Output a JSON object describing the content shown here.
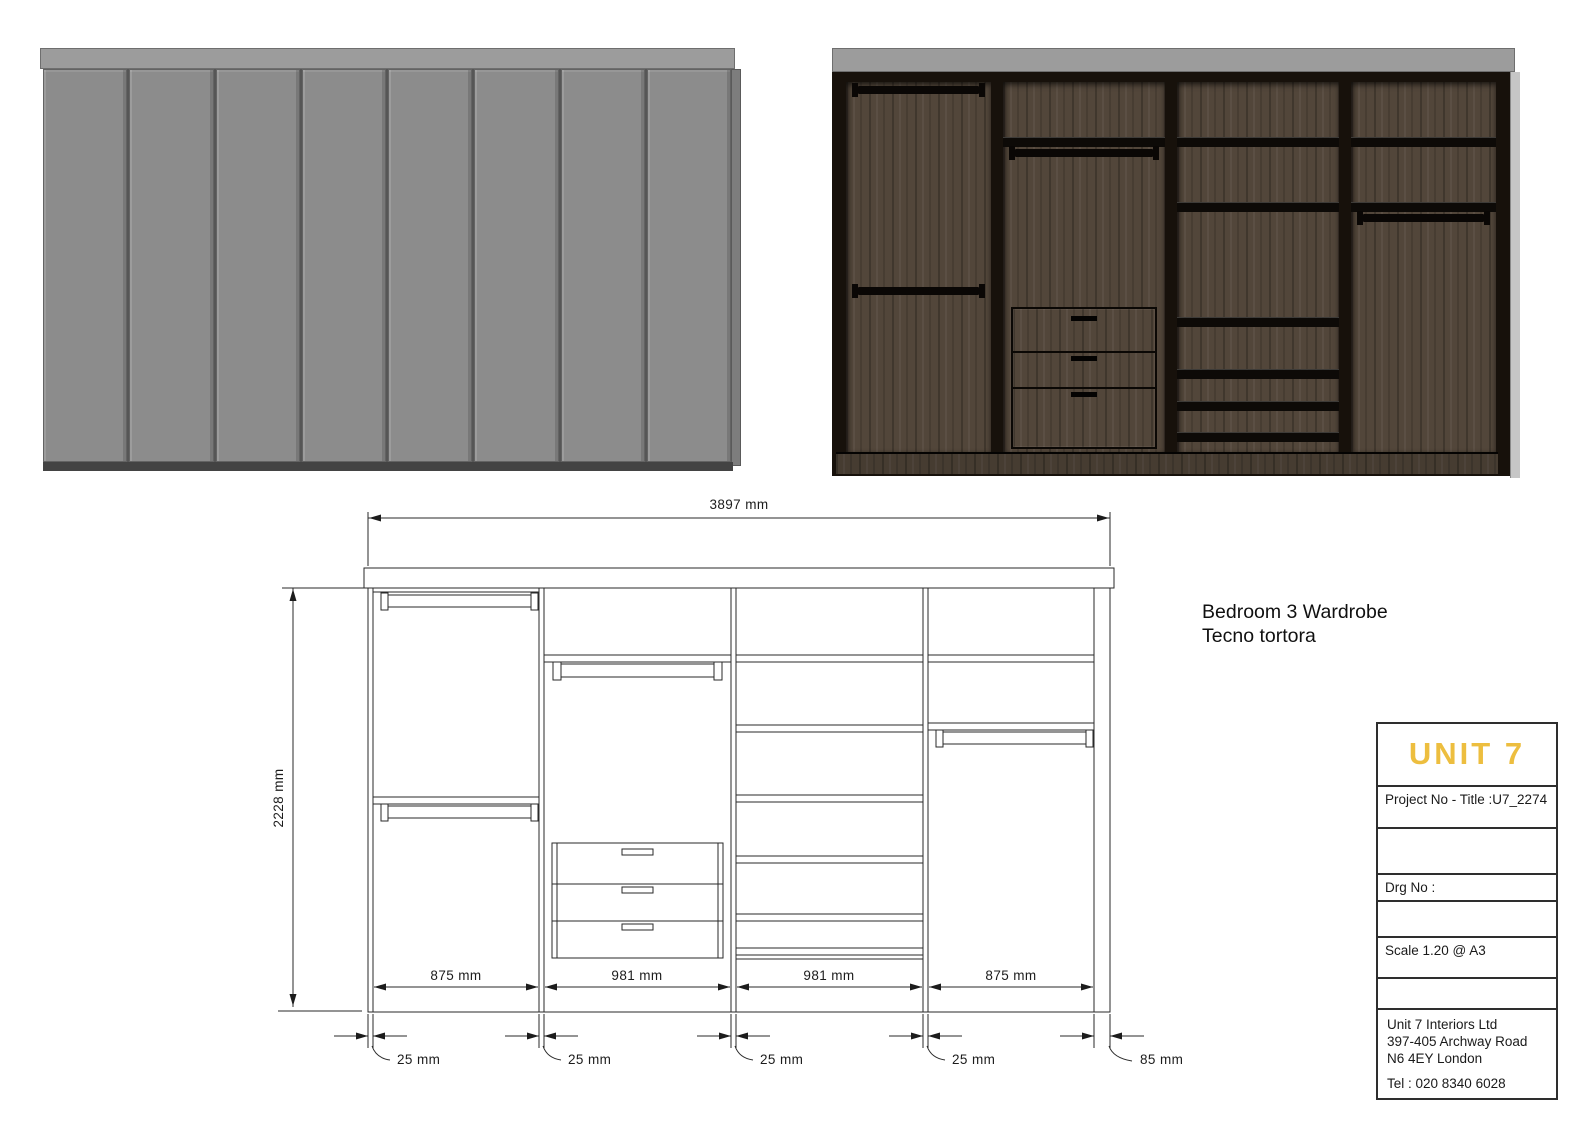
{
  "colors": {
    "accent_gold": "#EDBE3F",
    "drawing_line": "#2A2A2A",
    "door_gray": "#8C8C8C",
    "top_strip_gray": "#9C9C9C",
    "wood_brown": "#52463A",
    "frame_dark": "#17110B"
  },
  "annotation": {
    "line1": "Bedroom 3 Wardrobe",
    "line2": "Tecno tortora"
  },
  "dimensions": {
    "total_width": "3897 mm",
    "total_height": "2228 mm",
    "sections": [
      "875 mm",
      "981 mm",
      "981 mm",
      "875 mm"
    ],
    "thicknesses": [
      "25 mm",
      "25 mm",
      "25 mm",
      "25 mm",
      "85 mm"
    ]
  },
  "title_block": {
    "logo": "UNIT 7",
    "project": "Project No - Title :U7_2274",
    "drg": "Drg No :",
    "scale": "Scale 1.20 @ A3",
    "address": [
      "Unit 7 Interiors Ltd",
      "397-405 Archway Road",
      "N6 4EY London"
    ],
    "tel": "Tel : 020 8340 6028"
  }
}
